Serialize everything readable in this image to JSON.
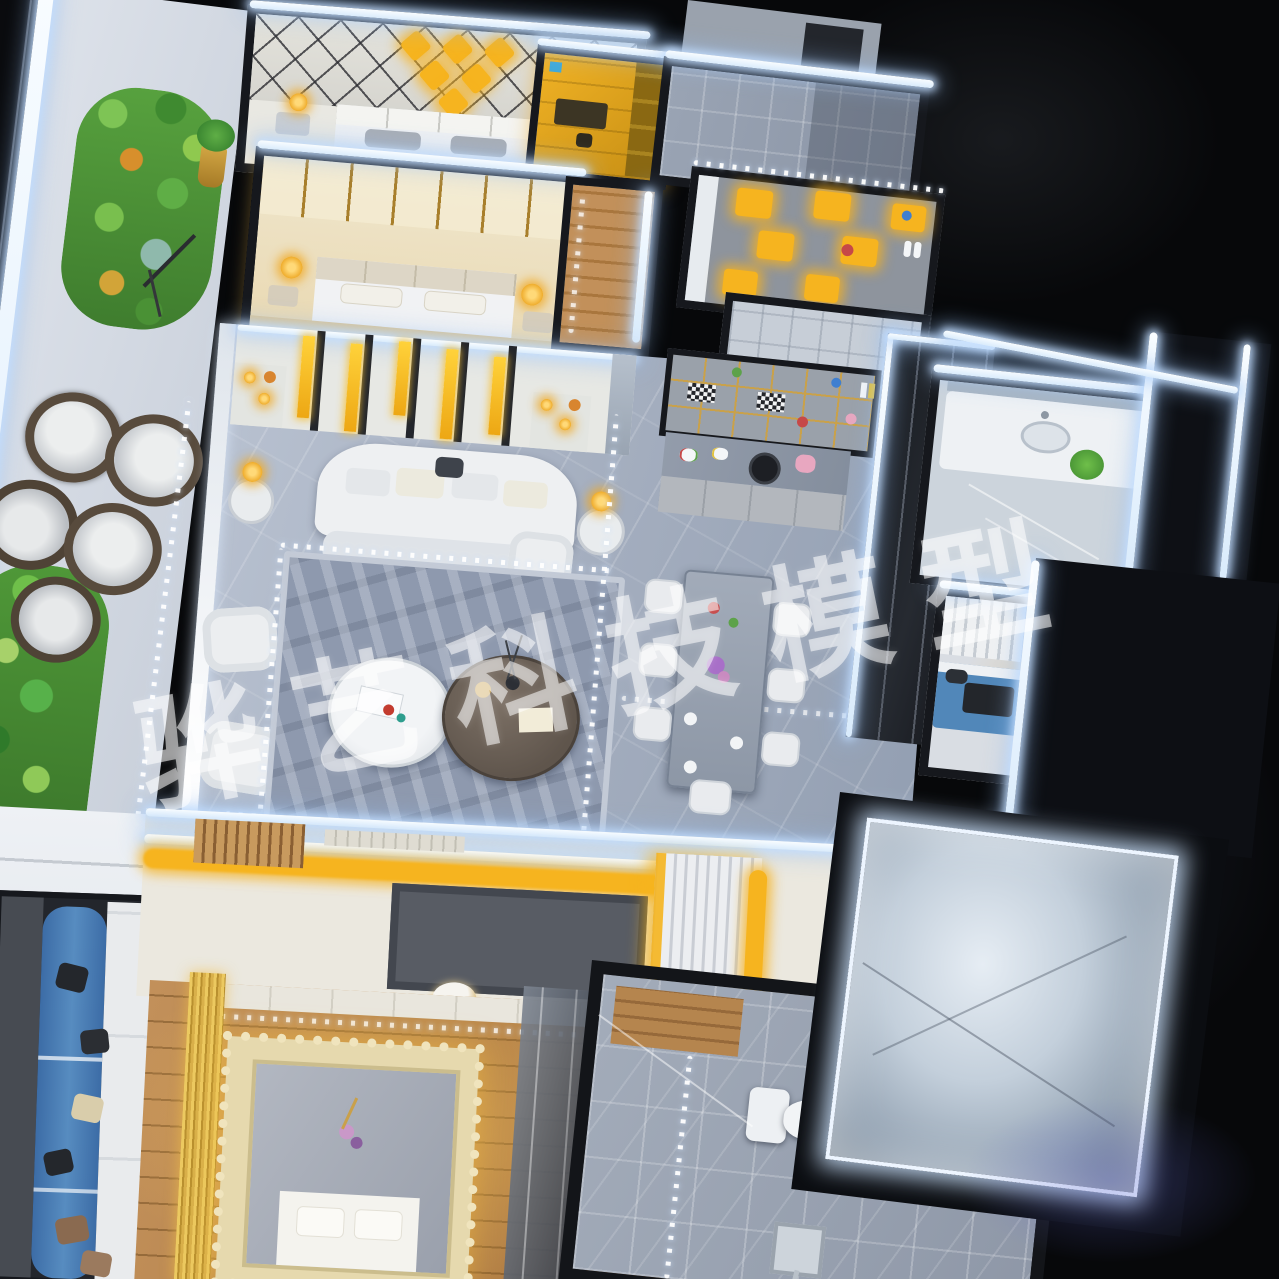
{
  "scene": {
    "description": "Night photograph, top-down view of an illuminated miniature apartment scale model (architectural maquette) with LED strip lighting",
    "background_color": "#07080a",
    "watermark": {
      "text": "骅艺科技模型",
      "color": "rgba(255,255,255,0.55)",
      "rotation_deg": -11.5
    },
    "palette": {
      "led_white": "#eaf4ff",
      "warm_amber": "#f5b41f",
      "gold_trim": "#c9a04a",
      "marble_floor": "#a7b1c2",
      "wood_floor": "#b8864c",
      "tile_gray": "#99a2b1",
      "wall_white": "#e9ecf1",
      "wall_dark": "#16181d",
      "plant_green": "#57a13e",
      "rattan_brown": "#5c4f40",
      "sofa_blue": "#4f7fb5",
      "art_blue": "#2f6fd0",
      "lace_cream": "#e6d9ae",
      "glass_dark": "#0e1015",
      "purple_glow": "#5f64cd"
    },
    "regions": [
      {
        "name": "garden-terrace",
        "desc": "balcony terrace with succulent planters and round rattan lounge chairs"
      },
      {
        "name": "bedroom-diamond",
        "desc": "bedroom with gold diamond-lattice headboard wall"
      },
      {
        "name": "walk-in-closet",
        "desc": "amber-lit walk-in closet"
      },
      {
        "name": "bedroom-warm",
        "desc": "bedroom with warm gold-striped walls and pendant lamps"
      },
      {
        "name": "bathroom-top",
        "desc": "gray tiled bathroom"
      },
      {
        "name": "display-shelf-room",
        "desc": "shelf wall with amber backlit niches"
      },
      {
        "name": "living-room",
        "desc": "living room with curved white sofa, twin coffee tables, gold slatted feature wall"
      },
      {
        "name": "dining-area",
        "desc": "dining table with white chairs and display cabinet with miniature props"
      },
      {
        "name": "kitchen",
        "desc": "white island behind dark glass partition"
      },
      {
        "name": "bathroom-right",
        "desc": "bathroom with white vanity, sink and plant"
      },
      {
        "name": "bedroom-right",
        "desc": "bedroom with blue bed, amber desk and blue artwork"
      },
      {
        "name": "glass-panels-right",
        "desc": "dark glass panels edged with white LED strips"
      },
      {
        "name": "lounge-bottom-left",
        "desc": "lounge sofa with blue bolster cushions and scattered pillows"
      },
      {
        "name": "bedroom-bottom",
        "desc": "wood-floor bedroom with lace-trimmed canopy bed and amber cove lighting"
      },
      {
        "name": "bathroom-bottom",
        "desc": "gray marble bathroom with toilet and shower fitting"
      },
      {
        "name": "lightbox-bottom-right",
        "desc": "LED edge-lit glass panel with diagonal reflections"
      }
    ]
  }
}
